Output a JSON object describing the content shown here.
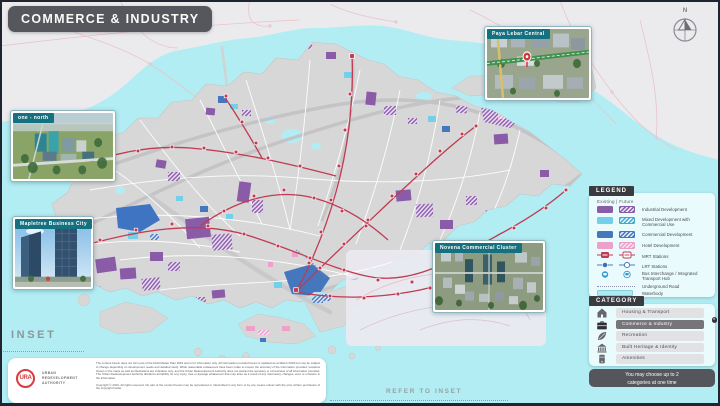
{
  "header": {
    "title": "COMMERCE & INDUSTRY"
  },
  "compass": {
    "north_label": "N"
  },
  "photo_insets": [
    {
      "label": "one - north"
    },
    {
      "label": "Mapletree Business City"
    },
    {
      "label": "Paya Lebar Central"
    },
    {
      "label": "Novena Commercial Cluster"
    }
  ],
  "legend": {
    "title": "LEGEND",
    "columns_label": "Existing  |  Future",
    "items": [
      {
        "label": "Industrial Development",
        "type": "area",
        "color": "#8a5ca8"
      },
      {
        "label": "Mixed Development with Commercial Use",
        "type": "area",
        "color": "#74cfe8"
      },
      {
        "label": "Commercial Development",
        "type": "area",
        "color": "#4577be"
      },
      {
        "label": "Hotel Development",
        "type": "area",
        "color": "#eda0c9"
      },
      {
        "label": "MRT Stations",
        "type": "mrt-station",
        "color": "#c03a52"
      },
      {
        "label": "LRT Stations",
        "type": "lrt-station",
        "color": "#3f6fb5"
      },
      {
        "label": "Bus Interchange / Integrated Transport Hub",
        "type": "bus-interchange",
        "color": "#2f9bd0"
      },
      {
        "label": "Underground Road",
        "type": "underground-road",
        "color": "#8f8fa8"
      },
      {
        "label": "Waterbody",
        "type": "waterbody",
        "color": "#aeeaf2"
      }
    ]
  },
  "category": {
    "title": "CATEGORY",
    "close_icon": "✕",
    "note": "You may choose up to 2 categories at one time",
    "items": [
      {
        "label": "Housing & Transport",
        "icon": "home-icon",
        "selected": false
      },
      {
        "label": "Commerce & Industry",
        "icon": "briefcase-icon",
        "selected": true
      },
      {
        "label": "Recreation",
        "icon": "leaf-icon",
        "selected": false
      },
      {
        "label": "Built Heritage & Identity",
        "icon": "heritage-building-icon",
        "selected": false
      },
      {
        "label": "Amenities",
        "icon": "amenities-icon",
        "selected": false
      }
    ]
  },
  "inset": {
    "label": "INSET",
    "refer_label": "REFER TO INSET"
  },
  "footer": {
    "logo": {
      "monogram": "URA",
      "org_lines": [
        "URBAN",
        "REDEVELOPMENT",
        "AUTHORITY"
      ]
    },
    "disclaimer": "The content herein does not form part of the Draft Master Plan 2019 and is for information only. All information provided herein is updated as at March 2019 but may be subject to change depending on development needs and detailed study. While reasonable endeavours have been made to ensure the accuracy of the information provided, locations shown in the maps as well as illustrations are indicative only, and the Urban Redevelopment Authority does not warrant the accuracy or correctness of all information provided. The Urban Redevelopment Authority disclaims all liability for any injury, loss or damage whatsoever that may arise as a result of any inaccuracy, changes, error or omission in the information.",
    "copyright": "Copyright © 2019. All rights reserved. No part of the content herein may be reproduced or transmitted in any form or by any means unless with the prior written permission of the copyright holder."
  },
  "colors": {
    "water": "#b2edf3",
    "land": "#d7d7d7",
    "outside_boundary": "#ebebee",
    "mrt_line": "#c03a52",
    "industrial": "#8a5ca8",
    "mixed_commercial": "#74cfe8",
    "commercial": "#4577be",
    "hotel": "#eda0c9",
    "panel_bg": "#e9fbfd",
    "dark_ui": "#3a3b40",
    "photo_tag": "#15707f",
    "header_bg": "#56575c"
  }
}
